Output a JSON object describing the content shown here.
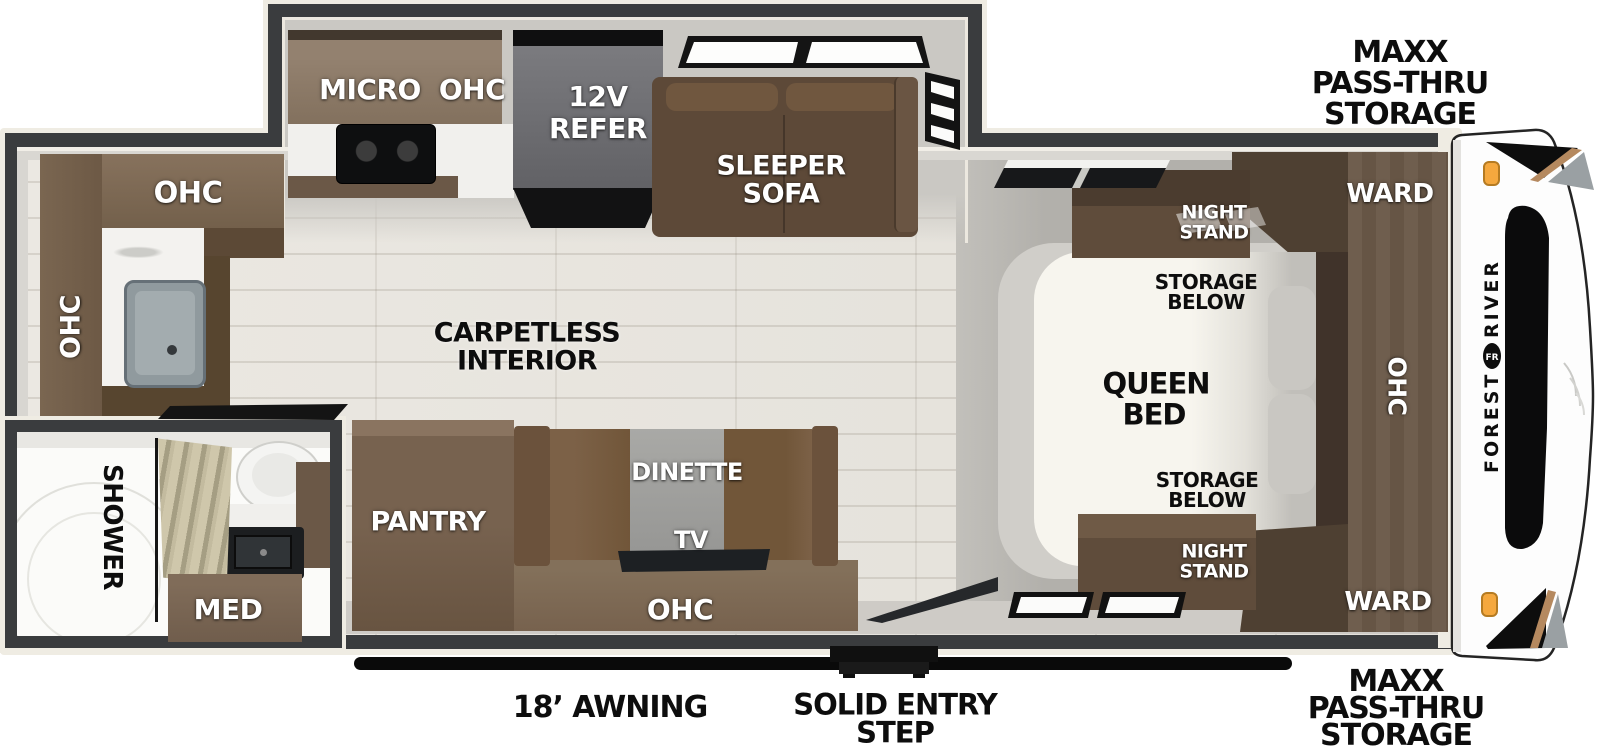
{
  "labels": {
    "ohc": "OHC",
    "micro": "MICRO",
    "refer_l1": "12V",
    "refer_l2": "REFER",
    "sleeper_l1": "SLEEPER",
    "sleeper_l2": "SOFA",
    "ward": "WARD",
    "night_l1": "NIGHT",
    "night_l2": "STAND",
    "storage_l1": "STORAGE",
    "storage_l2": "BELOW",
    "queen_l1": "QUEEN",
    "queen_l2": "BED",
    "carpetless_l1": "CARPETLESS",
    "carpetless_l2": "INTERIOR",
    "pantry": "PANTRY",
    "dinette": "DINETTE",
    "tv": "TV",
    "shower": "SHOWER",
    "med": "MED"
  },
  "exterior": {
    "maxx_l1": "MAXX",
    "maxx_l2": "PASS-THRU",
    "maxx_l3": "STORAGE",
    "awning": "18’ AWNING",
    "step_l1": "SOLID ENTRY",
    "step_l2": "STEP",
    "brand_l1": "FOREST",
    "brand_l2": "RIVER",
    "logo": "FR"
  },
  "colors": {
    "wall": "#3a3c3e",
    "trim": "#efece3",
    "floor_wood": "#e9e6e0",
    "floor_gray": "#b2b0ab",
    "cabinet_brown": "#6f5b49",
    "cabinet_dark": "#4e4032",
    "sofa_brown": "#5d4938",
    "refer_gray": "#6a6a6e",
    "bed_white": "#f7f5ee",
    "marker_light_orange": "#f5a83e",
    "accent_bronze": "#b5895f"
  }
}
